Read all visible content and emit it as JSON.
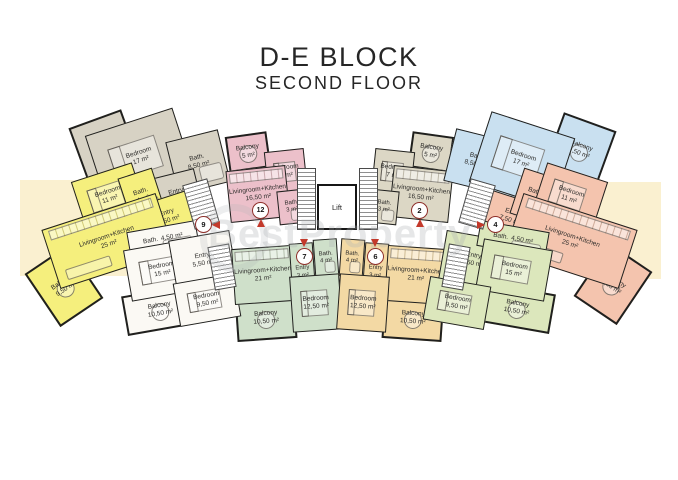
{
  "title": {
    "block": "D-E BLOCK",
    "floor": "SECOND FLOOR"
  },
  "watermark": "BestProperty",
  "lift": {
    "label": "Lift"
  },
  "palette": {
    "wall": "#20201e",
    "marker_red": "#c3392b",
    "marker_ring": "#8e2f2a",
    "cream_background": "#faf0d0",
    "corridor": "#ffffff"
  },
  "markers": [
    {
      "n": "9"
    },
    {
      "n": "12"
    },
    {
      "n": "2"
    },
    {
      "n": "4"
    },
    {
      "n": "7"
    },
    {
      "n": "6"
    }
  ],
  "units": {
    "grey_top_left": {
      "color": "#d7d2c4",
      "rooms": {
        "balcony": {
          "name": "Balcony",
          "area": "9,50 m²"
        },
        "bedroom": {
          "name": "Bedroom",
          "area": "17 m²"
        },
        "bath": {
          "name": "Bath.",
          "area": "8,50 m²"
        },
        "entry": {
          "name": "Entry",
          "area": "4,50 m²"
        }
      }
    },
    "yellow_left": {
      "color": "#f5ef7d",
      "marker": "9",
      "rooms": {
        "bedroom": {
          "name": "Bedroom",
          "area": "11 m²"
        },
        "bath": {
          "name": "Bath.",
          "area": "4 m²"
        },
        "entry": {
          "name": "Entry",
          "area": "7,50 m²"
        },
        "living": {
          "name": "Livingroom+Kitchen",
          "area": "25 m²"
        },
        "balcony": {
          "name": "Balcony",
          "area": "9,50 m²"
        }
      }
    },
    "pink_center_left": {
      "color": "#ecc0ca",
      "marker": "12",
      "rooms": {
        "balcony": {
          "name": "Balcony",
          "area": "5 m²"
        },
        "bedroom": {
          "name": "Bedroom",
          "area": "7 m²"
        },
        "living": {
          "name": "Livingroom+Kitchen",
          "area": "16,50 m²"
        },
        "bath": {
          "name": "Bath.",
          "area": "3 m²"
        }
      }
    },
    "beige_center_right": {
      "color": "#dcd7c5",
      "marker": "2",
      "rooms": {
        "balcony": {
          "name": "Balcony",
          "area": "5 m²"
        },
        "bedroom": {
          "name": "Bedroom",
          "area": "7 m²"
        },
        "living": {
          "name": "Livingroom+Kitchen",
          "area": "16,50 m²"
        },
        "bath": {
          "name": "Bath.",
          "area": "3 m²"
        }
      }
    },
    "blue_top_right": {
      "color": "#c9e0f0",
      "rooms": {
        "bath": {
          "name": "Bath.",
          "area": "8,50 m²"
        },
        "entry": {
          "name": "Entry",
          "area": "4,50 m²"
        },
        "bedroom": {
          "name": "Bedroom",
          "area": "17 m²"
        },
        "balcony": {
          "name": "Balcony",
          "area": "9,50 m²"
        }
      }
    },
    "orange_right": {
      "color": "#f4c4ae",
      "marker": "4",
      "rooms": {
        "entry": {
          "name": "Entry",
          "area": "7,50 m²"
        },
        "bath": {
          "name": "Bath.",
          "area": "4 m²"
        },
        "bedroom": {
          "name": "Bedroom",
          "area": "11 m²"
        },
        "living": {
          "name": "Livingroom+Kitchen",
          "area": "25 m²"
        },
        "balcony": {
          "name": "Balcony",
          "area": "9,50 m²"
        }
      }
    },
    "white_bottom_left": {
      "color": "#fbf9f4",
      "rooms": {
        "bath": {
          "name": "Bath.",
          "area": "4,50 m²"
        },
        "bedroom_large": {
          "name": "Bedroom",
          "area": "15 m²"
        },
        "entry": {
          "name": "Entry",
          "area": "5,50 m²"
        },
        "bedroom_small": {
          "name": "Bedroom",
          "area": "9,50 m²"
        },
        "balcony": {
          "name": "Balcony",
          "area": "10,50 m²"
        }
      }
    },
    "green_bottom_left": {
      "color": "#cfe0ca",
      "marker": "7",
      "rooms": {
        "entry": {
          "name": "Entry",
          "area": "3 m²"
        },
        "bath": {
          "name": "Bath.",
          "area": "4 m²"
        },
        "bedroom": {
          "name": "Bedroom",
          "area": "12,50 m²"
        },
        "living": {
          "name": "Livingroom+Kitchen",
          "area": "21 m²"
        },
        "balcony": {
          "name": "Balcony",
          "area": "10,50 m²"
        }
      }
    },
    "tan_bottom_center": {
      "color": "#f3d9a4",
      "marker": "6",
      "rooms": {
        "bath": {
          "name": "Bath.",
          "area": "4 m²"
        },
        "entry": {
          "name": "Entry",
          "area": "3 m²"
        },
        "bedroom": {
          "name": "Bedroom",
          "area": "12,50 m²"
        },
        "living": {
          "name": "Livingroom+Kitchen",
          "area": "21 m²"
        },
        "balcony": {
          "name": "Balcony",
          "area": "10,50 m²"
        }
      }
    },
    "green_bottom_right": {
      "color": "#dce7bc",
      "rooms": {
        "entry": {
          "name": "Entry",
          "area": "5,50 m²"
        },
        "bath": {
          "name": "Bath.",
          "area": "4,50 m²"
        },
        "bedroom_large": {
          "name": "Bedroom",
          "area": "15 m²"
        },
        "bedroom_small": {
          "name": "Bedroom",
          "area": "9,50 m²"
        },
        "balcony": {
          "name": "Balcony",
          "area": "10,50 m²"
        }
      }
    }
  }
}
